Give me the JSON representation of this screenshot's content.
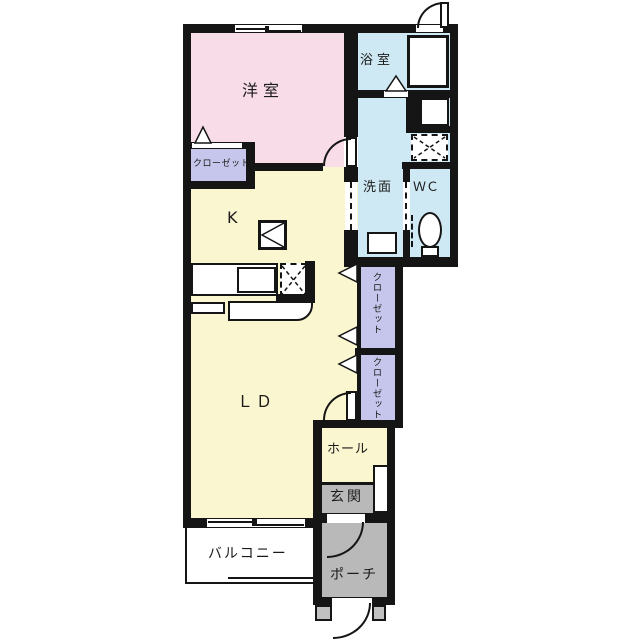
{
  "title": "1LDK apartment floor plan",
  "rooms": {
    "bedroom": {
      "label": "洋室"
    },
    "bath": {
      "label": "浴室"
    },
    "washroom": {
      "label": "洗面"
    },
    "toilet": {
      "label": "ＷＣ"
    },
    "closet_bedroom": {
      "label": "クローゼット"
    },
    "kitchen": {
      "label": "K"
    },
    "living_dining": {
      "label": "ＬＤ"
    },
    "closet_upper": {
      "label": "クローゼット"
    },
    "closet_lower": {
      "label": "クローゼット"
    },
    "hall": {
      "label": "ホール"
    },
    "entrance": {
      "label": "玄関"
    },
    "balcony": {
      "label": "バルコニー"
    },
    "porch": {
      "label": "ポーチ"
    }
  },
  "fixtures": [
    "bathtub",
    "washing-machine-space",
    "vanity-sink",
    "toilet-bowl",
    "cooktop",
    "kitchen-counter",
    "kitchen-sink",
    "refrigerator-space",
    "shoe-cabinet",
    "sliding-window",
    "entry-door",
    "folding-door"
  ],
  "colors": {
    "bedroom_pink": "#f8dce8",
    "ldk_yellow": "#faf6d0",
    "wet_blue": "#cfe9f4",
    "closet_purple": "#c6c6ec",
    "entry_gray": "#b9b9b9",
    "wall_black": "#151515"
  }
}
